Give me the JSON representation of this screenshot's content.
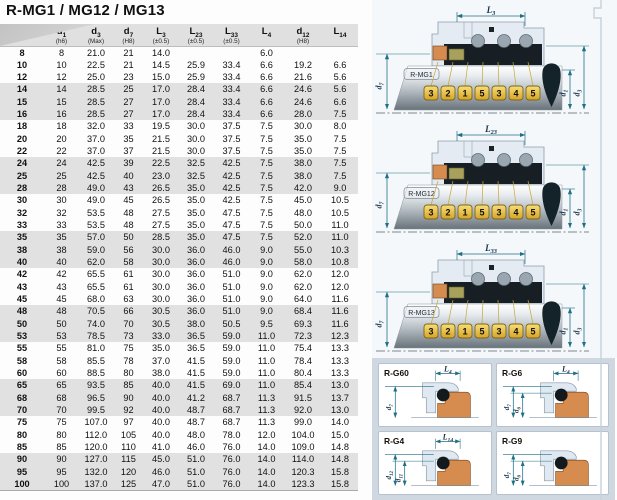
{
  "title": "R-MG1 / MG12 / MG13",
  "table": {
    "columns": [
      {
        "main": "d1",
        "sub": "(h6)"
      },
      {
        "main": "d3",
        "sub": "(Max)"
      },
      {
        "main": "d7",
        "sub": "(H8)"
      },
      {
        "main": "L3",
        "sub": "(±0.5)"
      },
      {
        "main": "L23",
        "sub": "(±0.5)"
      },
      {
        "main": "L33",
        "sub": "(±0.5)"
      },
      {
        "main": "L4",
        "sub": ""
      },
      {
        "main": "d12",
        "sub": "(H8)"
      },
      {
        "main": "L14",
        "sub": ""
      }
    ],
    "rows": [
      [
        "8",
        "8",
        "21.0",
        "21",
        "14.0",
        "",
        "",
        "6.0",
        "",
        ""
      ],
      [
        "10",
        "10",
        "22.5",
        "21",
        "14.5",
        "25.9",
        "33.4",
        "6.6",
        "19.2",
        "6.6"
      ],
      [
        "12",
        "12",
        "25.0",
        "23",
        "15.0",
        "25.9",
        "33.4",
        "6.6",
        "21.6",
        "5.6"
      ],
      [
        "14",
        "14",
        "28.5",
        "25",
        "17.0",
        "28.4",
        "33.4",
        "6.6",
        "24.6",
        "5.6"
      ],
      [
        "15",
        "15",
        "28.5",
        "27",
        "17.0",
        "28.4",
        "33.4",
        "6.6",
        "24.6",
        "6.6"
      ],
      [
        "16",
        "16",
        "28.5",
        "27",
        "17.0",
        "28.4",
        "33.4",
        "6.6",
        "28.0",
        "7.5"
      ],
      [
        "18",
        "18",
        "32.0",
        "33",
        "19.5",
        "30.0",
        "37.5",
        "7.5",
        "30.0",
        "8.0"
      ],
      [
        "20",
        "20",
        "37.0",
        "35",
        "21.5",
        "30.0",
        "37.5",
        "7.5",
        "35.0",
        "7.5"
      ],
      [
        "22",
        "22",
        "37.0",
        "37",
        "21.5",
        "30.0",
        "37.5",
        "7.5",
        "35.0",
        "7.5"
      ],
      [
        "24",
        "24",
        "42.5",
        "39",
        "22.5",
        "32.5",
        "42.5",
        "7.5",
        "38.0",
        "7.5"
      ],
      [
        "25",
        "25",
        "42.5",
        "40",
        "23.0",
        "32.5",
        "42.5",
        "7.5",
        "38.0",
        "7.5"
      ],
      [
        "28",
        "28",
        "49.0",
        "43",
        "26.5",
        "35.0",
        "42.5",
        "7.5",
        "42.0",
        "9.0"
      ],
      [
        "30",
        "30",
        "49.0",
        "45",
        "26.5",
        "35.0",
        "42.5",
        "7.5",
        "45.0",
        "10.5"
      ],
      [
        "32",
        "32",
        "53.5",
        "48",
        "27.5",
        "35.0",
        "47.5",
        "7.5",
        "48.0",
        "10.5"
      ],
      [
        "33",
        "33",
        "53.5",
        "48",
        "27.5",
        "35.0",
        "47.5",
        "7.5",
        "50.0",
        "11.0"
      ],
      [
        "35",
        "35",
        "57.0",
        "50",
        "28.5",
        "35.0",
        "47.5",
        "7.5",
        "52.0",
        "11.0"
      ],
      [
        "38",
        "38",
        "59.0",
        "56",
        "30.0",
        "36.0",
        "46.0",
        "9.0",
        "55.0",
        "10.3"
      ],
      [
        "40",
        "40",
        "62.0",
        "58",
        "30.0",
        "36.0",
        "46.0",
        "9.0",
        "58.0",
        "10.8"
      ],
      [
        "42",
        "42",
        "65.5",
        "61",
        "30.0",
        "36.0",
        "51.0",
        "9.0",
        "62.0",
        "12.0"
      ],
      [
        "43",
        "43",
        "65.5",
        "61",
        "30.0",
        "36.0",
        "51.0",
        "9.0",
        "62.0",
        "12.0"
      ],
      [
        "45",
        "45",
        "68.0",
        "63",
        "30.0",
        "36.0",
        "51.0",
        "9.0",
        "64.0",
        "11.6"
      ],
      [
        "48",
        "48",
        "70.5",
        "66",
        "30.5",
        "36.0",
        "51.0",
        "9.0",
        "68.4",
        "11.6"
      ],
      [
        "50",
        "50",
        "74.0",
        "70",
        "30.5",
        "38.0",
        "50.5",
        "9.5",
        "69.3",
        "11.6"
      ],
      [
        "53",
        "53",
        "78.5",
        "73",
        "33.0",
        "36.5",
        "59.0",
        "11.0",
        "72.3",
        "12.3"
      ],
      [
        "55",
        "55",
        "81.0",
        "75",
        "35.0",
        "36.5",
        "59.0",
        "11.0",
        "75.4",
        "13.3"
      ],
      [
        "58",
        "58",
        "85.5",
        "78",
        "37.0",
        "41.5",
        "59.0",
        "11.0",
        "78.4",
        "13.3"
      ],
      [
        "60",
        "60",
        "88.5",
        "80",
        "38.0",
        "41.5",
        "59.0",
        "11.0",
        "80.4",
        "13.3"
      ],
      [
        "65",
        "65",
        "93.5",
        "85",
        "40.0",
        "41.5",
        "69.0",
        "11.0",
        "85.4",
        "13.0"
      ],
      [
        "68",
        "68",
        "96.5",
        "90",
        "40.0",
        "41.2",
        "68.7",
        "11.3",
        "91.5",
        "13.7"
      ],
      [
        "70",
        "70",
        "99.5",
        "92",
        "40.0",
        "48.7",
        "68.7",
        "11.3",
        "92.0",
        "13.0"
      ],
      [
        "75",
        "75",
        "107.0",
        "97",
        "40.0",
        "48.7",
        "68.7",
        "11.3",
        "99.0",
        "14.0"
      ],
      [
        "80",
        "80",
        "112.0",
        "105",
        "40.0",
        "48.0",
        "78.0",
        "12.0",
        "104.0",
        "15.0"
      ],
      [
        "85",
        "85",
        "120.0",
        "110",
        "41.0",
        "46.0",
        "76.0",
        "14.0",
        "109.0",
        "14.8"
      ],
      [
        "90",
        "90",
        "127.0",
        "115",
        "45.0",
        "51.0",
        "76.0",
        "14.0",
        "114.0",
        "14.8"
      ],
      [
        "95",
        "95",
        "132.0",
        "120",
        "46.0",
        "51.0",
        "76.0",
        "14.0",
        "120.3",
        "15.8"
      ],
      [
        "100",
        "100",
        "137.0",
        "125",
        "47.0",
        "51.0",
        "76.0",
        "14.0",
        "123.3",
        "15.8"
      ]
    ]
  },
  "diagrams": [
    {
      "label": "R-MG1",
      "top_dim": "L3",
      "left_dim": "d7",
      "right_dims": [
        "d1",
        "d3"
      ],
      "callouts": [
        "3",
        "2",
        "1",
        "5",
        "3",
        "4",
        "5"
      ]
    },
    {
      "label": "R-MG12",
      "top_dim": "L23",
      "left_dim": "d7",
      "right_dims": [
        "d1",
        "d3"
      ],
      "callouts": [
        "3",
        "2",
        "1",
        "5",
        "3",
        "4",
        "5"
      ]
    },
    {
      "label": "R-MG13",
      "top_dim": "L33",
      "left_dim": "d7",
      "right_dims": [
        "d1",
        "d3"
      ],
      "callouts": [
        "3",
        "2",
        "1",
        "5",
        "3",
        "4",
        "5"
      ]
    }
  ],
  "cards": [
    {
      "label": "R-G60",
      "top_dim": "L4",
      "left_dims": [
        "d7"
      ]
    },
    {
      "label": "R-G6",
      "top_dim": "L4",
      "left_dims": [
        "d7",
        "d6"
      ]
    },
    {
      "label": "R-G4",
      "top_dim": "L14",
      "left_dims": [
        "d12",
        "d11"
      ]
    },
    {
      "label": "R-G9",
      "top_dim": "",
      "left_dims": [
        "d7",
        "d6"
      ]
    }
  ],
  "colors": {
    "teal_dim": "#1f6f85",
    "gold_hi": "#f4da6e",
    "gold_lo": "#d9a92c",
    "orange_face": "#d68b4f",
    "olive_face": "#a8a15c",
    "stripe": "#e1e1e1",
    "header_bg": "#e0e0e0",
    "panel_bottom_bg": "#cfd8e1",
    "black_part": "#181f24"
  }
}
